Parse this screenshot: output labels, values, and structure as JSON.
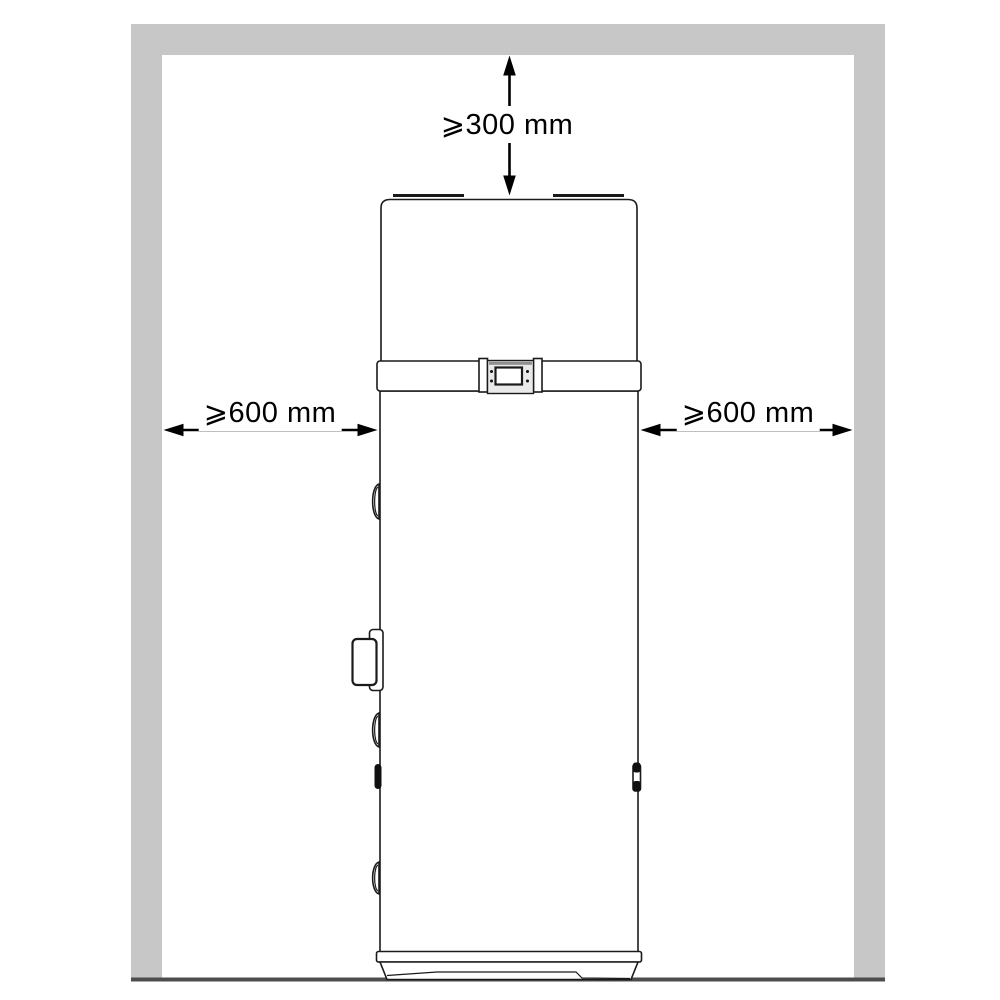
{
  "diagram": {
    "clearances": {
      "top": "⩾300 mm",
      "left": "⩾600 mm",
      "right": "⩾600 mm"
    },
    "colors": {
      "wall": "#c7c7c7",
      "floor": "#4d4d4d",
      "line": "#1a1a1a",
      "background": "#ffffff"
    }
  }
}
